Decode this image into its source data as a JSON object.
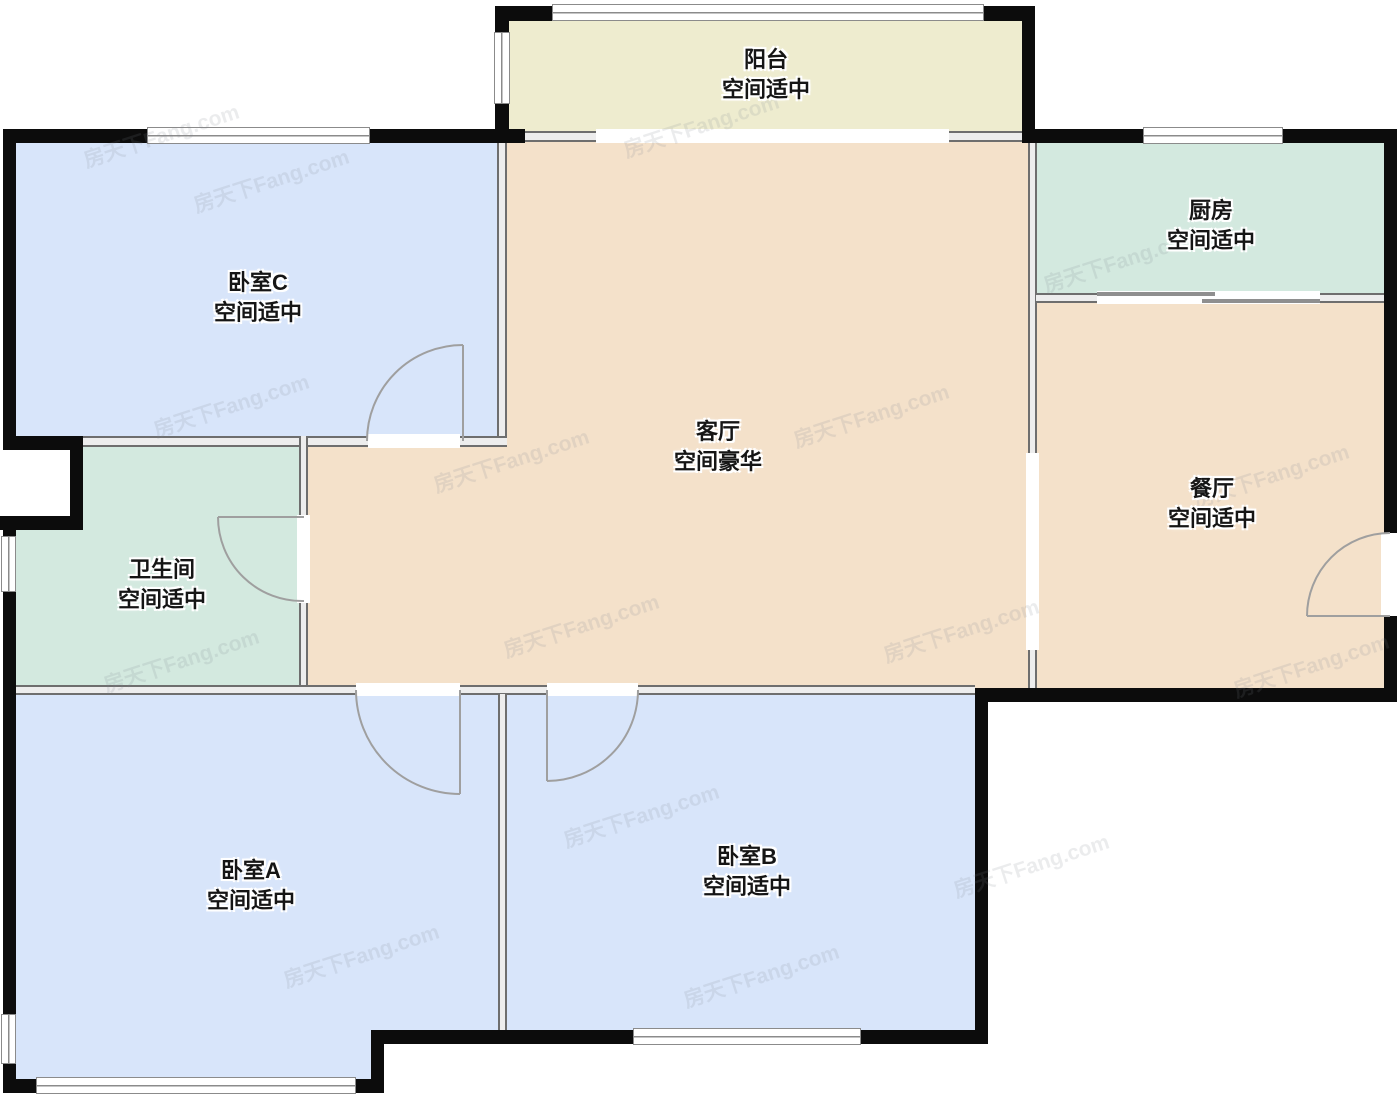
{
  "title": "户型图",
  "watermark": {
    "text": "房天下Fang.com"
  },
  "colors": {
    "bedroom": "#d8e5fa",
    "living": "#f4e1ca",
    "kitchen_bath": "#d3e9df",
    "balcony": "#eeeccf",
    "wall_black": "#0c0c0c",
    "wall_gray": "#6e6e6e",
    "door_arc": "#9f9f9f"
  },
  "rooms": {
    "balcony": {
      "name": "阳台",
      "rating": "空间适中"
    },
    "bedroom_c": {
      "name": "卧室C",
      "rating": "空间适中"
    },
    "kitchen": {
      "name": "厨房",
      "rating": "空间适中"
    },
    "living": {
      "name": "客厅",
      "rating": "空间豪华"
    },
    "dining": {
      "name": "餐厅",
      "rating": "空间适中"
    },
    "bathroom": {
      "name": "卫生间",
      "rating": "空间适中"
    },
    "bedroom_a": {
      "name": "卧室A",
      "rating": "空间适中"
    },
    "bedroom_b": {
      "name": "卧室B",
      "rating": "空间适中"
    }
  }
}
